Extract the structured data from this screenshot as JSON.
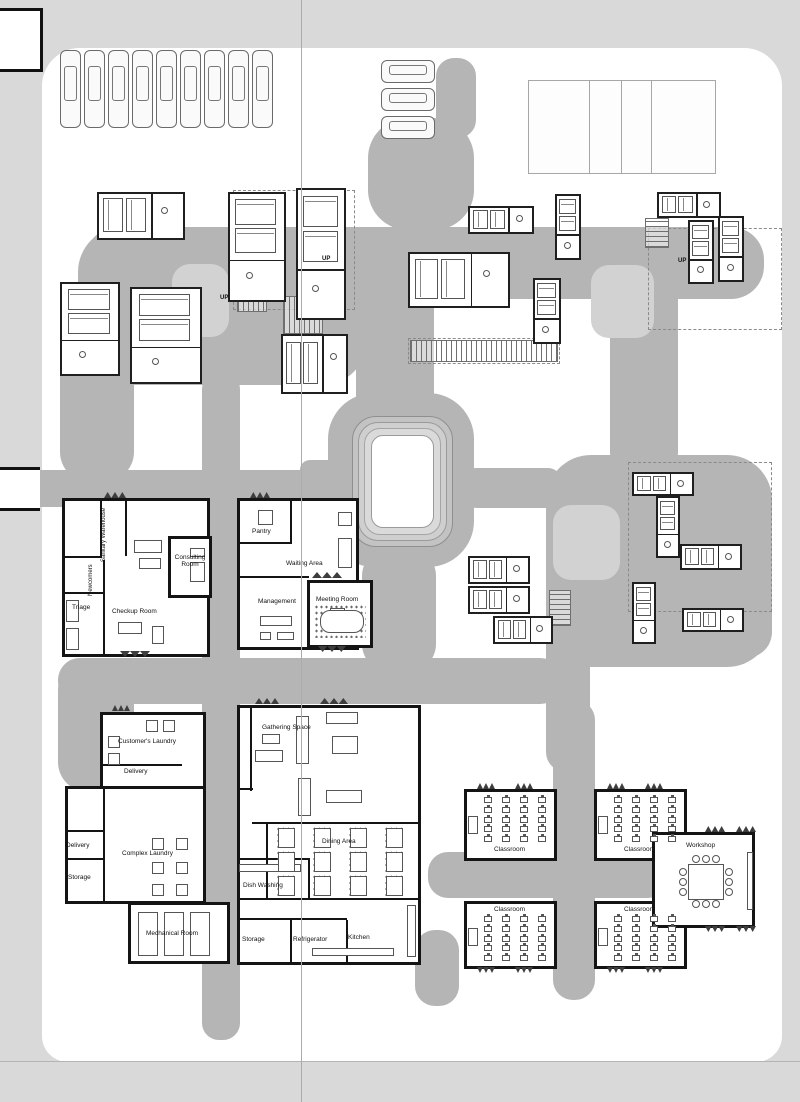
{
  "title": "Campus ground floor site plan",
  "colors": {
    "background": "#d9d9d9",
    "sheet": "#ffffff",
    "path": "#b5b5b5",
    "courtyard": "#d2d2d2",
    "wall": "#141414",
    "furniture_line": "#555555"
  },
  "labels": {
    "sanitary_warehouse": "Sanitary Warehouse",
    "newcomers": "Newcomers",
    "triage": "Triage",
    "checkup_room": "Checkup Room",
    "consulting_room": "Consulting Room",
    "pantry": "Pantry",
    "waiting_area": "Waiting Area",
    "management": "Management",
    "meeting_room": "Meeting Room",
    "customers_laundry": "Customer's Laundry",
    "delivery": "Delivery",
    "complex_laundry": "Complex Laundry",
    "storage": "Storage",
    "mechanical_room": "Mechanical Room",
    "gathering_space": "Gathering Space",
    "dining_area": "Dining Area",
    "dish_washing": "Dish Washing",
    "refrigerator": "Refrigerator",
    "kitchen": "Kitchen",
    "classroom": "Classroom",
    "workshop": "Workshop",
    "up": "UP"
  },
  "counts": {
    "cars_top_row": 9,
    "cars_side": 3,
    "court_sections": 4,
    "classrooms": 4,
    "dorm_units": 21,
    "courtyards": 3
  }
}
